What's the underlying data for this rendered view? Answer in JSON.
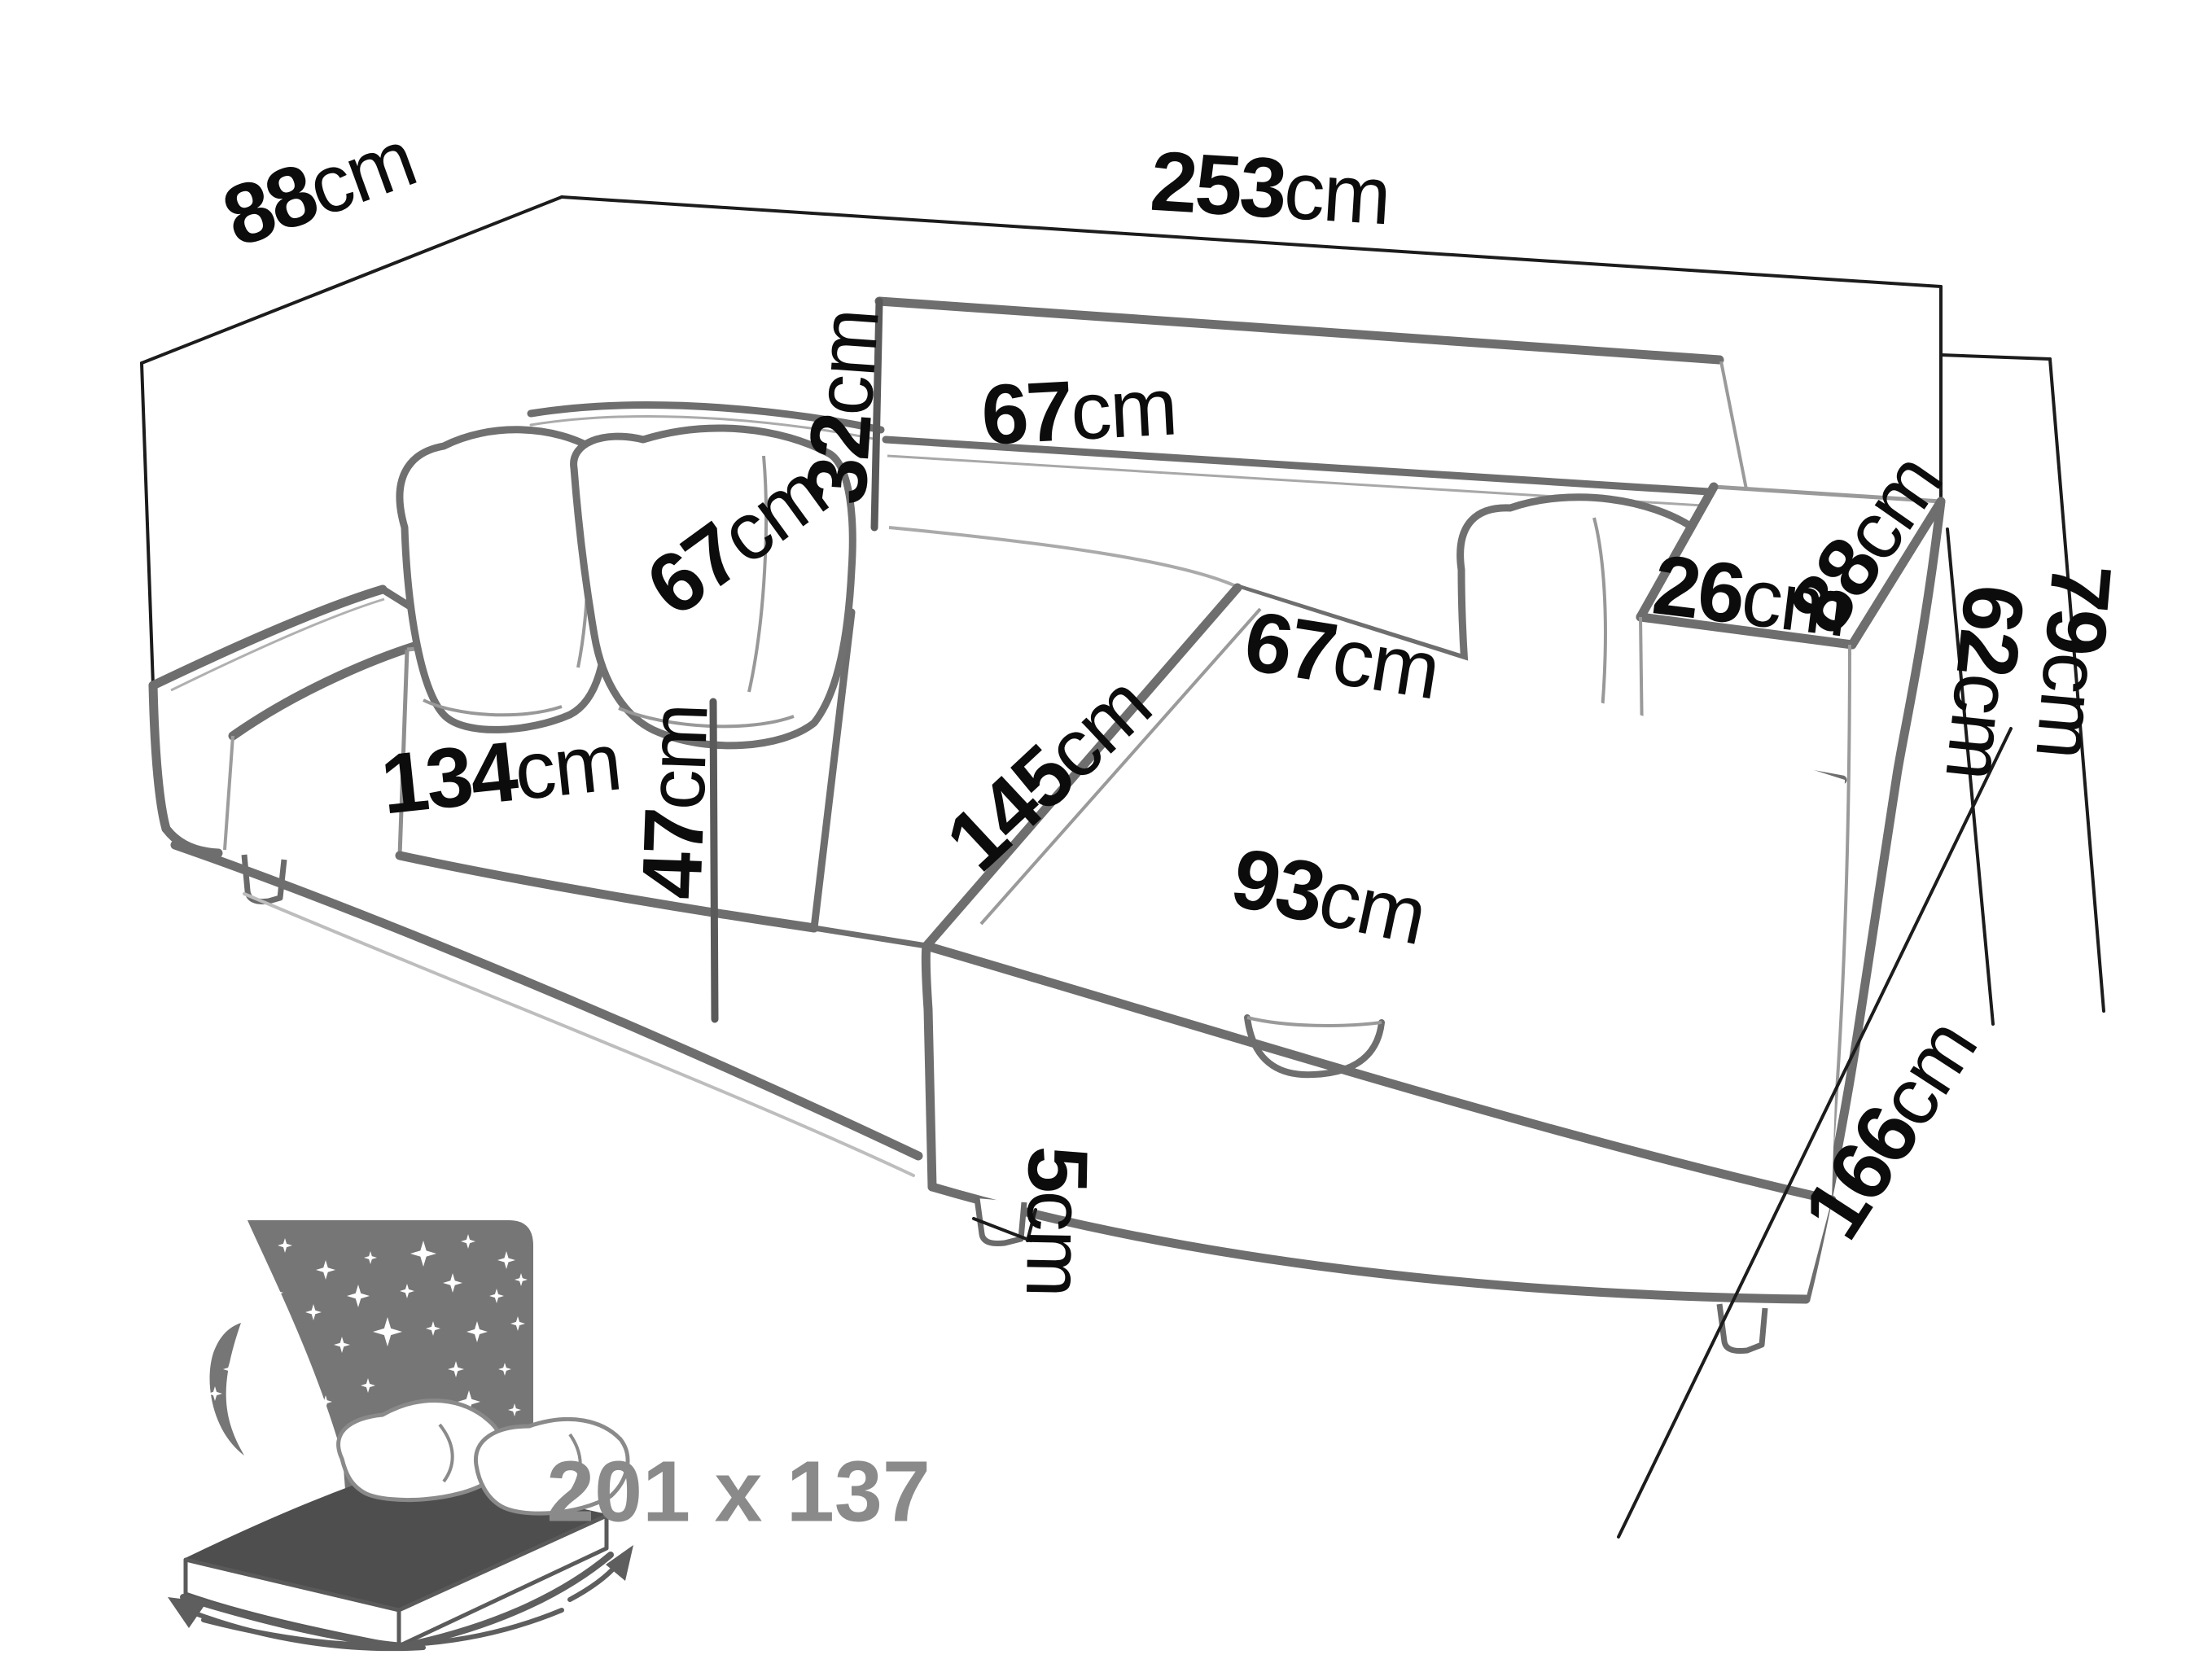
{
  "dims": {
    "total_width": {
      "value": "253",
      "unit": "cm"
    },
    "back_depth": {
      "value": "88",
      "unit": "cm"
    },
    "backrest_height": {
      "value": "32",
      "unit": "cm"
    },
    "backrest_width": {
      "value": "67",
      "unit": "cm"
    },
    "seat_depth": {
      "value": "67",
      "unit": "cm"
    },
    "seat_width": {
      "value": "134",
      "unit": "cm"
    },
    "armrest_width": {
      "value": "26",
      "unit": "cm"
    },
    "armrest_length": {
      "value": "88",
      "unit": "cm"
    },
    "armrest_height": {
      "value": "62",
      "unit": "cm"
    },
    "total_height": {
      "value": "79",
      "unit": "cm"
    },
    "seat_height": {
      "value": "47",
      "unit": "cm"
    },
    "chaise_length": {
      "value": "145",
      "unit": "cm"
    },
    "chaise_seat_width": {
      "value": "67",
      "unit": "cm"
    },
    "chaise_width": {
      "value": "93",
      "unit": "cm"
    },
    "leg_height": {
      "value": "5",
      "unit": "cm"
    },
    "side_depth": {
      "value": "166",
      "unit": "cm"
    }
  },
  "bed_icon": {
    "size_label": "201 x 137"
  }
}
